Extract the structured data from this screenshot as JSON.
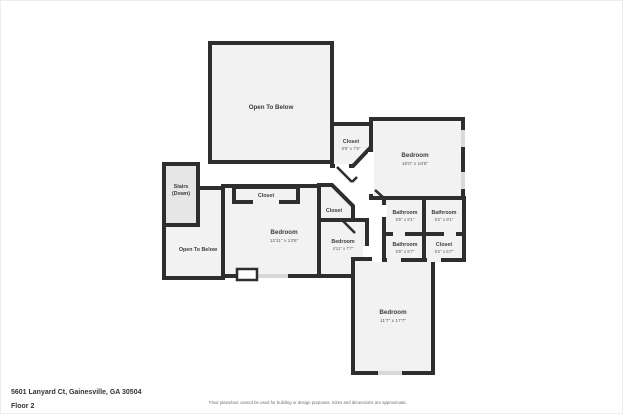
{
  "rooms": {
    "open_below_top": {
      "name": "Open To Below"
    },
    "closet_top_right": {
      "name": "Closet",
      "dims": "5'9\" x 7'6\""
    },
    "bedroom_right": {
      "name": "Bedroom",
      "dims": "16'0\" x 18'8\""
    },
    "bathroom_a": {
      "name": "Bathroom",
      "dims": "5'5\" x 9'1\""
    },
    "bathroom_b": {
      "name": "Bathroom",
      "dims": "5'2\" x 9'1\""
    },
    "bathroom_c": {
      "name": "Bathroom",
      "dims": "5'5\" x 5'7\""
    },
    "closet_bath": {
      "name": "Closet",
      "dims": "5'2\" x 5'7\""
    },
    "stairs": {
      "name": "Stairs",
      "sub": "(Down)"
    },
    "closet_center": {
      "name": "Closet"
    },
    "bedroom_center": {
      "name": "Bedroom",
      "dims": "12'11\" x 13'6\""
    },
    "closet_mid": {
      "name": "Closet"
    },
    "bedroom_small": {
      "name": "Bedroom",
      "dims": "4'11\" x 7'7\""
    },
    "open_below_left": {
      "name": "Open To Below"
    },
    "bedroom_bottom": {
      "name": "Bedroom",
      "dims": "11'7\" x 17'7\""
    }
  },
  "footer": {
    "address": "5601 Lanyard Ct, Gainesville, GA 30504",
    "floor": "Floor 2",
    "disclaimer": "Floor plans/tour cannot be used for building or design purposes. Sizes and dimensions are approximate."
  },
  "colors": {
    "wall": "#2e2e2e",
    "room_fill": "#f2f2f2",
    "stairs_fill": "#e6e6e6",
    "window": "#d9d9d9",
    "background": "#ffffff"
  }
}
